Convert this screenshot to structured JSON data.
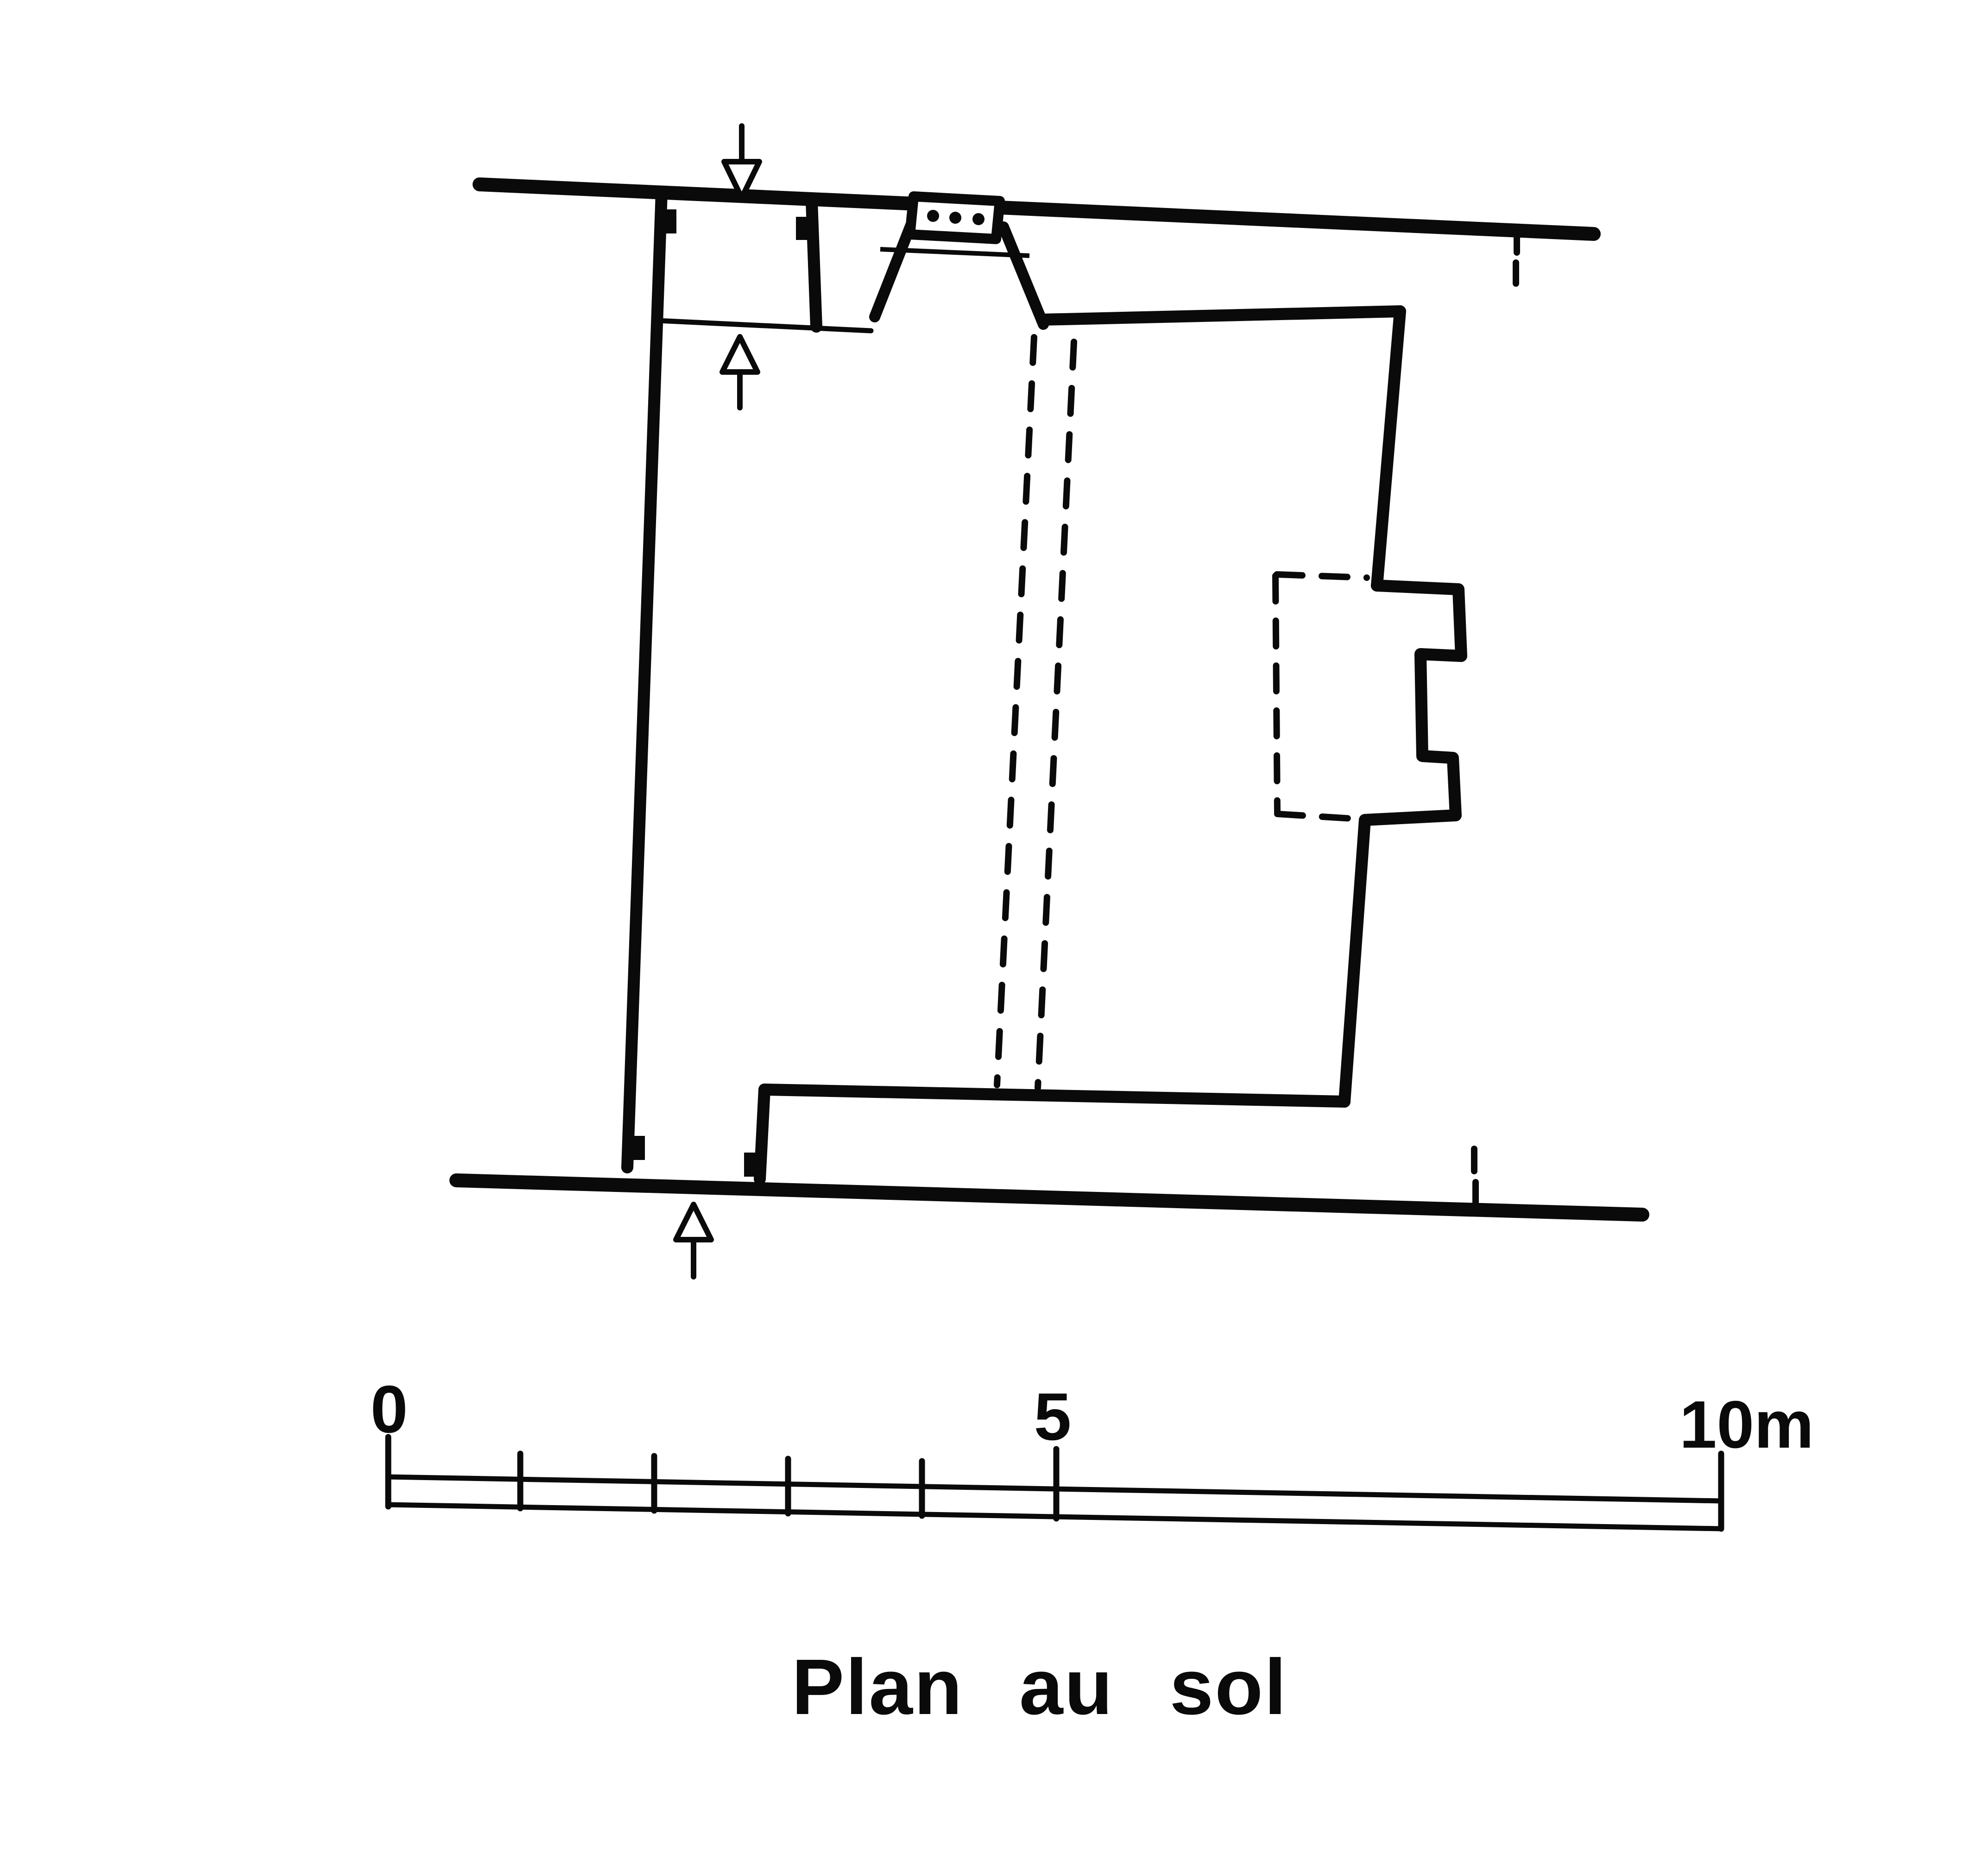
{
  "drawing": {
    "title": "Plan au sol",
    "ink_color": "#0a0a0a",
    "paper_color": "#ffffff"
  },
  "scale_bar": {
    "labels": {
      "zero": "0",
      "five": "5",
      "ten": "10m"
    },
    "unit": "m",
    "tick_values_m": [
      0,
      1,
      2,
      3,
      4,
      5,
      10
    ]
  },
  "icons": {
    "entrance_arrow_top": "hollow-triangle-arrow-down",
    "entrance_arrow_middle": "hollow-triangle-arrow-up",
    "entrance_arrow_bottom": "hollow-triangle-arrow-up",
    "window_grille": "three-dots"
  }
}
